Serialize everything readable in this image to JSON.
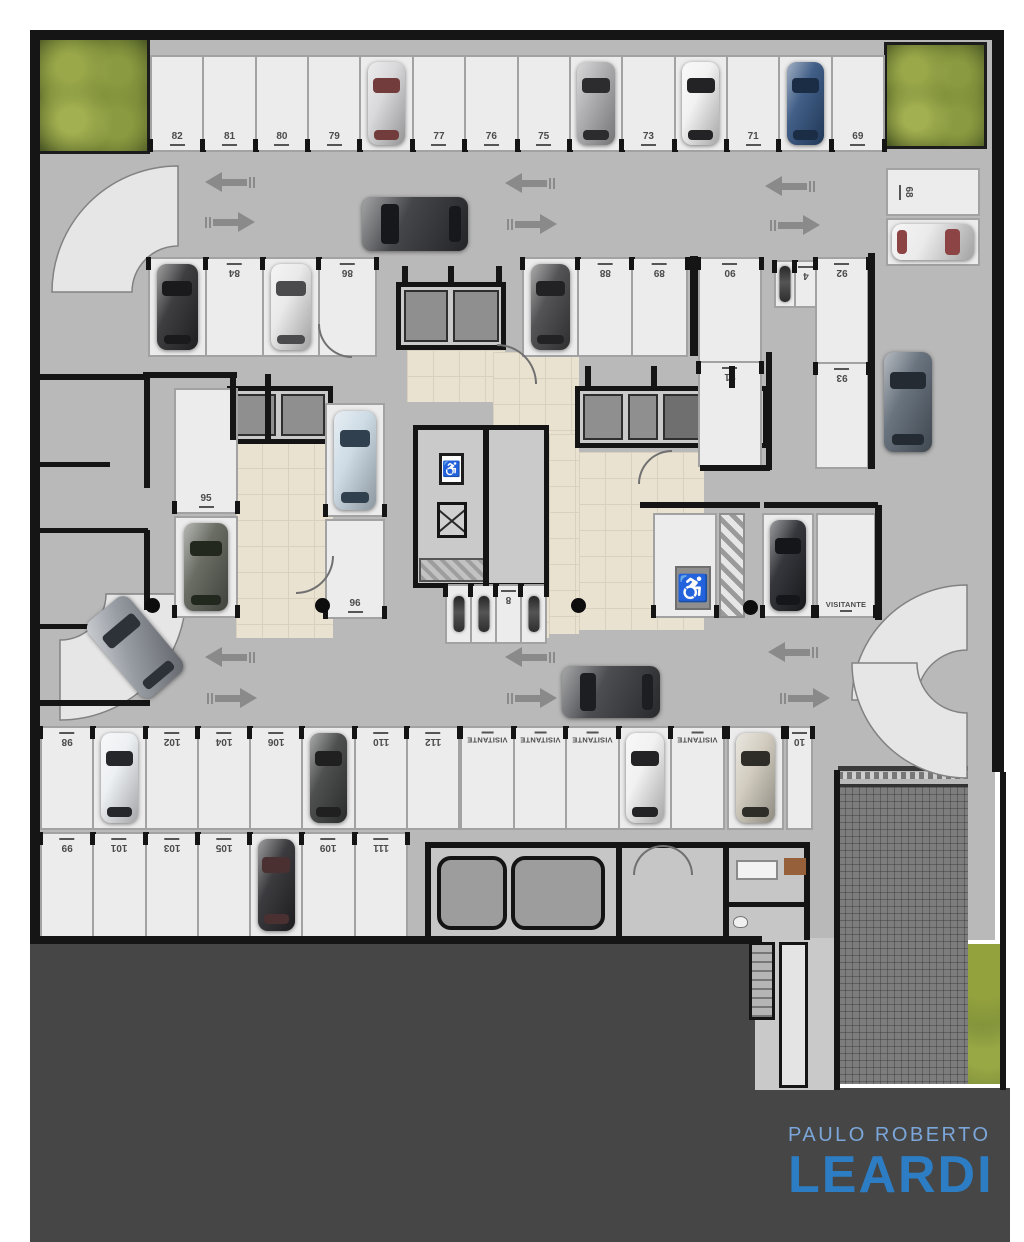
{
  "logo": {
    "line1": "PAULO ROBERTO",
    "line2": "LEARDI",
    "color_top": "#7ba6d9",
    "color_main": "#2d7dc4",
    "background": "#464646"
  },
  "icons": {
    "wheelchair": "♿"
  },
  "plan": {
    "colors": {
      "floor": "#b9b9b9",
      "stall": "#ececec",
      "wall": "#151515",
      "lobby_tile": "#eae2d1",
      "ground": "#464646",
      "arrow": "#8a8a8a"
    },
    "regions": [
      {
        "t": "floor",
        "n": "garage-floor",
        "x": 36,
        "y": 36,
        "w": 959,
        "h": 904
      },
      {
        "t": "dark",
        "n": "ground-bottom-left",
        "x": 30,
        "y": 944,
        "w": 728,
        "h": 298
      },
      {
        "t": "dark",
        "n": "ground-bottom-right",
        "x": 755,
        "y": 1088,
        "w": 255,
        "h": 154
      },
      {
        "t": "lightzone",
        "n": "stair-zone",
        "x": 755,
        "y": 938,
        "w": 84,
        "h": 152
      },
      {
        "t": "ramp",
        "n": "ramp-down",
        "x": 838,
        "y": 784,
        "w": 130,
        "h": 300
      },
      {
        "t": "veg",
        "n": "vegetation-strip",
        "x": 968,
        "y": 944,
        "w": 34,
        "h": 140
      },
      {
        "t": "planter",
        "n": "planter-top-left",
        "x": 37,
        "y": 37,
        "w": 113,
        "h": 117
      },
      {
        "t": "planter",
        "n": "planter-top-right",
        "x": 884,
        "y": 42,
        "w": 103,
        "h": 107
      },
      {
        "t": "beige",
        "n": "lobby-left",
        "x": 236,
        "y": 442,
        "w": 97,
        "h": 196
      },
      {
        "t": "beige",
        "n": "lobby-center-top",
        "x": 407,
        "y": 350,
        "w": 98,
        "h": 52
      },
      {
        "t": "beige",
        "n": "lobby-center",
        "x": 493,
        "y": 352,
        "w": 86,
        "h": 82
      },
      {
        "t": "beige",
        "n": "lobby-center-strip",
        "x": 549,
        "y": 434,
        "w": 30,
        "h": 200
      },
      {
        "t": "beige",
        "n": "lobby-right",
        "x": 579,
        "y": 452,
        "w": 125,
        "h": 178
      },
      {
        "t": "beige",
        "n": "lobby-connector",
        "x": 455,
        "y": 596,
        "w": 94,
        "h": 42
      },
      {
        "t": "grayroom",
        "n": "elevator-core-left",
        "x": 227,
        "y": 386,
        "w": 106,
        "h": 58
      },
      {
        "t": "cell",
        "n": "elevator-cab",
        "x": 236,
        "y": 394,
        "w": 40,
        "h": 42
      },
      {
        "t": "cell",
        "n": "elevator-cab",
        "x": 281,
        "y": 394,
        "w": 44,
        "h": 42
      },
      {
        "t": "grayroom",
        "n": "storage-core-top",
        "x": 396,
        "y": 282,
        "w": 110,
        "h": 68
      },
      {
        "t": "cell",
        "n": "storage-cell",
        "x": 404,
        "y": 290,
        "w": 44,
        "h": 52
      },
      {
        "t": "cell",
        "n": "storage-cell",
        "x": 453,
        "y": 290,
        "w": 46,
        "h": 52
      },
      {
        "t": "grayroom",
        "n": "elevator-core-right",
        "x": 575,
        "y": 386,
        "w": 193,
        "h": 62
      },
      {
        "t": "cell",
        "n": "elevator-cab",
        "x": 583,
        "y": 394,
        "w": 40,
        "h": 46
      },
      {
        "t": "cell",
        "n": "elevator-cab",
        "x": 628,
        "y": 394,
        "w": 30,
        "h": 46
      },
      {
        "t": "celld",
        "n": "service-cell",
        "x": 663,
        "y": 394,
        "w": 98,
        "h": 46
      },
      {
        "t": "grayroom",
        "n": "stair-core-center",
        "x": 413,
        "y": 425,
        "w": 136,
        "h": 163
      },
      {
        "t": "xbox",
        "n": "stair-shaft",
        "x": 437,
        "y": 502,
        "w": 30,
        "h": 36
      },
      {
        "t": "hatch2",
        "n": "machine-hatch",
        "x": 419,
        "y": 558,
        "w": 66,
        "h": 24
      },
      {
        "t": "hatch",
        "n": "no-parking-hatch",
        "x": 719,
        "y": 513,
        "w": 26,
        "h": 105
      },
      {
        "t": "rooms",
        "n": "utility-rooms",
        "x": 425,
        "y": 842,
        "w": 385,
        "h": 98
      },
      {
        "t": "tank",
        "n": "water-tank",
        "x": 437,
        "y": 856,
        "w": 70,
        "h": 74
      },
      {
        "t": "tank",
        "n": "water-tank",
        "x": 511,
        "y": 856,
        "w": 94,
        "h": 74
      },
      {
        "t": "stairs",
        "n": "stairs-down",
        "x": 749,
        "y": 942,
        "w": 26,
        "h": 78
      },
      {
        "t": "corridor",
        "n": "service-corridor",
        "x": 779,
        "y": 942,
        "w": 29,
        "h": 146
      },
      {
        "t": "sofa",
        "n": "sofa",
        "x": 736,
        "y": 860,
        "w": 42,
        "h": 20
      },
      {
        "t": "wood",
        "n": "wood-floor",
        "x": 784,
        "y": 858,
        "w": 22,
        "h": 17
      },
      {
        "t": "toilet",
        "n": "toilet",
        "x": 733,
        "y": 916,
        "w": 15,
        "h": 12
      },
      {
        "t": "gate",
        "n": "entry-gate",
        "x": 838,
        "y": 766,
        "w": 130,
        "h": 5
      },
      {
        "t": "gatedash",
        "n": "entry-gate-dashes",
        "x": 838,
        "y": 772,
        "w": 130,
        "h": 7
      }
    ],
    "walls": [
      [
        30,
        30,
        974,
        10
      ],
      [
        30,
        30,
        10,
        914
      ],
      [
        992,
        30,
        12,
        742
      ],
      [
        1000,
        772,
        6,
        318
      ],
      [
        36,
        936,
        726,
        8
      ],
      [
        868,
        253,
        7,
        216
      ],
      [
        875,
        505,
        7,
        115
      ],
      [
        640,
        502,
        120,
        6
      ],
      [
        764,
        502,
        114,
        6
      ],
      [
        690,
        256,
        8,
        100
      ],
      [
        766,
        352,
        6,
        118
      ],
      [
        700,
        465,
        70,
        6
      ],
      [
        143,
        372,
        94,
        6
      ],
      [
        230,
        374,
        6,
        66
      ],
      [
        265,
        374,
        6,
        66
      ],
      [
        36,
        374,
        112,
        6
      ],
      [
        144,
        374,
        6,
        114
      ],
      [
        36,
        462,
        74,
        5
      ],
      [
        36,
        528,
        112,
        5
      ],
      [
        144,
        530,
        6,
        80
      ],
      [
        36,
        624,
        74,
        5
      ],
      [
        36,
        700,
        114,
        6
      ],
      [
        483,
        428,
        6,
        158
      ],
      [
        616,
        846,
        6,
        92
      ],
      [
        723,
        846,
        6,
        92
      ],
      [
        723,
        902,
        87,
        5
      ],
      [
        834,
        770,
        6,
        320
      ],
      [
        402,
        266,
        6,
        20
      ],
      [
        448,
        266,
        6,
        20
      ],
      [
        496,
        266,
        6,
        20
      ],
      [
        585,
        366,
        6,
        22
      ],
      [
        651,
        366,
        6,
        22
      ],
      [
        729,
        366,
        6,
        22
      ]
    ],
    "rows": [
      {
        "n": "row-top",
        "x": 150,
        "y": 55,
        "w": 735,
        "h": 97,
        "lab": "b",
        "cells": [
          {
            "nu": "82"
          },
          {
            "nu": "81"
          },
          {
            "nu": "80"
          },
          {
            "nu": "79"
          },
          {
            "car": {
              "c": "#d6d6d8",
              "g": "#733c3c"
            }
          },
          {
            "nu": "77"
          },
          {
            "nu": "76"
          },
          {
            "nu": "75"
          },
          {
            "car": {
              "c": "#a9a9ab",
              "g": "#2c2c2e"
            }
          },
          {
            "nu": "73"
          },
          {
            "car": {
              "c": "#f1f1f1",
              "g": "#232325"
            }
          },
          {
            "nu": "71"
          },
          {
            "car": {
              "c": "#31517d",
              "g": "#1b2c45"
            }
          },
          {
            "nu": "69"
          }
        ]
      },
      {
        "n": "row-mid-left",
        "x": 148,
        "y": 257,
        "w": 229,
        "h": 100,
        "lab": "t",
        "rot": 180,
        "cells": [
          {
            "car": {
              "c": "#2e2e30",
              "g": "#1a1a1c"
            }
          },
          {
            "nu": "84"
          },
          {
            "car": {
              "c": "#e8e8e8",
              "g": "#4b4b4d"
            }
          },
          {
            "nu": "86"
          }
        ]
      },
      {
        "n": "row-mid-center",
        "x": 522,
        "y": 257,
        "w": 166,
        "h": 100,
        "lab": "t",
        "rot": 180,
        "cells": [
          {
            "car": {
              "c": "#454547",
              "g": "#222224"
            }
          },
          {
            "nu": "88"
          },
          {
            "nu": "89"
          }
        ]
      },
      {
        "n": "col-90-91",
        "x": 698,
        "y": 257,
        "w": 64,
        "h": 210,
        "lab": "t",
        "rot": 180,
        "col": 1,
        "cells": [
          {
            "nu": "90"
          },
          {
            "nu": "91"
          }
        ]
      },
      {
        "n": "moto-stall-4",
        "x": 774,
        "y": 260,
        "w": 44,
        "h": 48,
        "lab": "t",
        "rot": 180,
        "cells": [
          {
            "moto": 1,
            "w": 20
          },
          {
            "nu": "4"
          }
        ]
      },
      {
        "n": "col-92-93",
        "x": 815,
        "y": 257,
        "w": 54,
        "h": 212,
        "lab": "t",
        "rot": 180,
        "col": 1,
        "cells": [
          {
            "nu": "92"
          },
          {
            "nu": "93"
          }
        ]
      },
      {
        "n": "stall-68-row",
        "x": 886,
        "y": 168,
        "w": 94,
        "h": 48,
        "lab": "l",
        "cells": [
          {
            "nu": "68"
          }
        ]
      },
      {
        "n": "stall-67-row",
        "x": 886,
        "y": 218,
        "w": 94,
        "h": 48,
        "lab": "l",
        "cells": [
          {
            "car": {
              "c": "#e9e9e9",
              "g": "#8d4444",
              "o": "h",
              "gs": "r"
            }
          }
        ]
      },
      {
        "n": "stall-95",
        "x": 174,
        "y": 388,
        "w": 64,
        "h": 126,
        "lab": "b",
        "cells": [
          {
            "nu": "95"
          }
        ]
      },
      {
        "n": "stall-95b",
        "x": 174,
        "y": 516,
        "w": 64,
        "h": 102,
        "lab": "b",
        "cells": [
          {
            "car": {
              "c": "#5d6157",
              "g": "#23281f"
            }
          }
        ]
      },
      {
        "n": "stall-96a",
        "x": 325,
        "y": 403,
        "w": 60,
        "h": 114,
        "lab": "b",
        "cells": [
          {
            "car": {
              "c": "#cad9e4",
              "g": "#31404e"
            }
          }
        ]
      },
      {
        "n": "stall-96",
        "x": 325,
        "y": 519,
        "w": 60,
        "h": 100,
        "lab": "b",
        "cells": [
          {
            "nu": "96"
          }
        ]
      },
      {
        "n": "stall-pcd",
        "x": 653,
        "y": 513,
        "w": 64,
        "h": 105,
        "lab": "b",
        "cells": [
          {}
        ]
      },
      {
        "n": "stall-visit-car",
        "x": 762,
        "y": 513,
        "w": 52,
        "h": 105,
        "lab": "b",
        "cells": [
          {
            "car": {
              "c": "#24262b",
              "g": "#14161a"
            }
          }
        ]
      },
      {
        "n": "stall-visit",
        "x": 816,
        "y": 513,
        "w": 60,
        "h": 105,
        "lab": "b",
        "cells": [
          {
            "nu": "VISITANTE"
          }
        ]
      },
      {
        "n": "row-bottom-upper",
        "x": 40,
        "y": 726,
        "w": 420,
        "h": 104,
        "lab": "t",
        "rot": 180,
        "cells": [
          {
            "nu": "98"
          },
          {
            "car": {
              "c": "#eceff2",
              "g": "#25272a"
            }
          },
          {
            "nu": "102"
          },
          {
            "nu": "104"
          },
          {
            "nu": "106"
          },
          {
            "car": {
              "c": "#3f4140",
              "g": "#1f201f"
            }
          },
          {
            "nu": "110"
          },
          {
            "nu": "112"
          }
        ]
      },
      {
        "n": "row-visitantes",
        "x": 460,
        "y": 726,
        "w": 265,
        "h": 104,
        "lab": "t",
        "rot": 180,
        "cells": [
          {
            "nu": "VISITANTE"
          },
          {
            "nu": "VISITANTE"
          },
          {
            "nu": "VISITANTE"
          },
          {
            "car": {
              "c": "#f0f0f0",
              "g": "#232325"
            }
          },
          {
            "nu": "VISITANTE"
          }
        ]
      },
      {
        "n": "stall-champagne",
        "x": 727,
        "y": 726,
        "w": 57,
        "h": 104,
        "lab": "t",
        "cells": [
          {
            "car": {
              "c": "#cfc9bb",
              "g": "#2f2d28"
            }
          }
        ]
      },
      {
        "n": "stall-10",
        "x": 786,
        "y": 726,
        "w": 27,
        "h": 104,
        "lab": "t",
        "rot": 180,
        "cells": [
          {
            "nu": "10"
          }
        ]
      },
      {
        "n": "row-bottom-lower",
        "x": 40,
        "y": 832,
        "w": 368,
        "h": 106,
        "lab": "t",
        "rot": 180,
        "cells": [
          {
            "nu": "99"
          },
          {
            "nu": "101"
          },
          {
            "nu": "103"
          },
          {
            "nu": "105"
          },
          {
            "car": {
              "c": "#2b2b2f",
              "g": "#4a3030"
            }
          },
          {
            "nu": "109"
          },
          {
            "nu": "111"
          }
        ]
      },
      {
        "n": "moto-stalls-center",
        "x": 445,
        "y": 584,
        "w": 102,
        "h": 60,
        "lab": "t",
        "rot": 180,
        "cells": [
          {
            "moto": 1
          },
          {
            "moto": 1
          },
          {
            "nu": "8"
          },
          {
            "moto": 1
          }
        ]
      }
    ],
    "cars": [
      {
        "n": "car-aisle-top",
        "x": 362,
        "y": 197,
        "w": 106,
        "h": 54,
        "o": "h",
        "gs": "l",
        "c": "#35363a",
        "g": "#17181c"
      },
      {
        "n": "car-lane-right",
        "x": 884,
        "y": 352,
        "w": 48,
        "h": 100,
        "o": "v",
        "c": "#5d6874",
        "g": "#252b33"
      },
      {
        "n": "car-aisle-bottom",
        "x": 562,
        "y": 666,
        "w": 98,
        "h": 52,
        "o": "h",
        "gs": "l",
        "c": "#3c3e42",
        "g": "#1c1e22"
      },
      {
        "n": "car-turning",
        "x": 108,
        "y": 598,
        "w": 54,
        "h": 98,
        "o": "v",
        "rot": -40,
        "c": "#8f949c",
        "g": "#2d3138"
      }
    ],
    "arrows": [
      {
        "x": 205,
        "y": 172,
        "d": "l"
      },
      {
        "x": 505,
        "y": 173,
        "d": "l"
      },
      {
        "x": 765,
        "y": 176,
        "d": "l"
      },
      {
        "x": 203,
        "y": 212,
        "d": "r"
      },
      {
        "x": 505,
        "y": 214,
        "d": "r"
      },
      {
        "x": 768,
        "y": 215,
        "d": "r"
      },
      {
        "x": 205,
        "y": 647,
        "d": "l"
      },
      {
        "x": 505,
        "y": 647,
        "d": "l"
      },
      {
        "x": 768,
        "y": 642,
        "d": "l"
      },
      {
        "x": 205,
        "y": 688,
        "d": "r"
      },
      {
        "x": 505,
        "y": 688,
        "d": "r"
      },
      {
        "x": 778,
        "y": 688,
        "d": "r"
      }
    ],
    "dots": [
      [
        152,
        605
      ],
      [
        322,
        605
      ],
      [
        578,
        605
      ],
      [
        750,
        607
      ]
    ],
    "signs": [
      {
        "t": "wc",
        "n": "handicap-parking-sign",
        "x": 675,
        "y": 566,
        "w": 36,
        "h": 44
      },
      {
        "t": "el",
        "n": "accessible-elevator-sign",
        "x": 439,
        "y": 453,
        "w": 25,
        "h": 32
      }
    ],
    "arcs": [
      {
        "x": 296,
        "y": 556,
        "s": 38,
        "q": 4
      },
      {
        "x": 497,
        "y": 344,
        "s": 40,
        "q": 2
      },
      {
        "x": 638,
        "y": 450,
        "s": 34,
        "q": 1
      },
      {
        "x": 318,
        "y": 324,
        "s": 34,
        "q": 3
      },
      {
        "x": 633,
        "y": 845,
        "s": 30,
        "q": 1
      },
      {
        "x": 663,
        "y": 845,
        "s": 30,
        "q": 2
      }
    ]
  }
}
